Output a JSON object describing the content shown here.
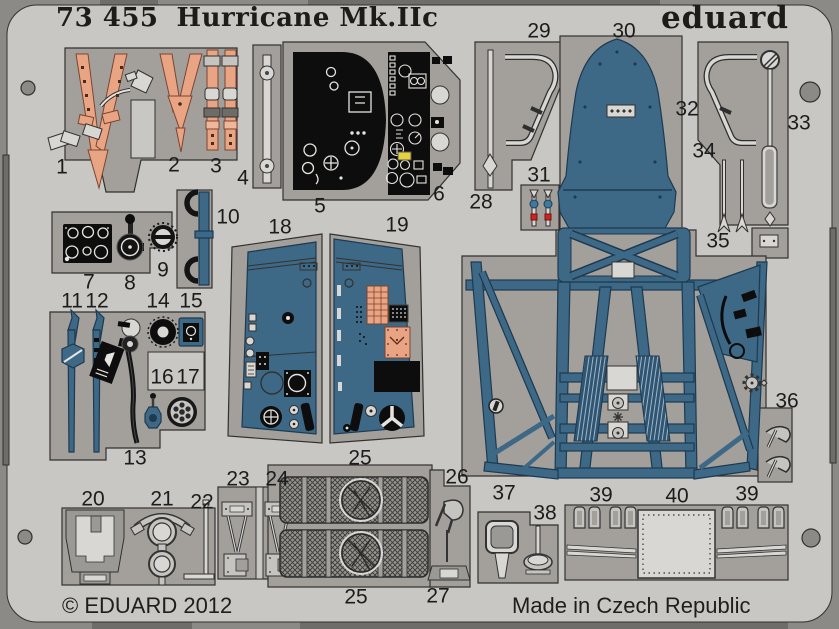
{
  "sheet": {
    "catalog_number": "73 455",
    "product_name": "Hurricane Mk.IIc",
    "brand": "eduard",
    "copyright": "© EDUARD 2012",
    "made_in": "Made in Czech Republic"
  },
  "colors": {
    "outer": "#8c8a86",
    "notch": "#6f6d69",
    "sheet": "#c9c7c3",
    "panel": "#a3a09c",
    "outline": "#33312e",
    "metal": "#c6c4c0",
    "metal_light": "#d9d7d3",
    "blue": "#3d6886",
    "blue_dark": "#1d3a50",
    "blue_tread": "#2f5573",
    "salmon": "#e9a484",
    "salmon_dark": "#7c4530",
    "black": "#0d0d0d",
    "red": "#c62820",
    "yellow": "#e3d23c",
    "white_detail": "#e6e4e0"
  },
  "part_labels": [
    {
      "n": "1",
      "x": 62,
      "y": 168
    },
    {
      "n": "2",
      "x": 174,
      "y": 166
    },
    {
      "n": "3",
      "x": 216,
      "y": 167
    },
    {
      "n": "4",
      "x": 243,
      "y": 179
    },
    {
      "n": "5",
      "x": 320,
      "y": 207
    },
    {
      "n": "6",
      "x": 439,
      "y": 195
    },
    {
      "n": "7",
      "x": 89,
      "y": 283
    },
    {
      "n": "8",
      "x": 130,
      "y": 284
    },
    {
      "n": "9",
      "x": 163,
      "y": 271
    },
    {
      "n": "10",
      "x": 228,
      "y": 218
    },
    {
      "n": "11",
      "x": 72,
      "y": 302
    },
    {
      "n": "12",
      "x": 97,
      "y": 302
    },
    {
      "n": "13",
      "x": 135,
      "y": 459
    },
    {
      "n": "14",
      "x": 158,
      "y": 302
    },
    {
      "n": "15",
      "x": 191,
      "y": 302
    },
    {
      "n": "16",
      "x": 162,
      "y": 378
    },
    {
      "n": "17",
      "x": 188,
      "y": 378
    },
    {
      "n": "18",
      "x": 280,
      "y": 228
    },
    {
      "n": "19",
      "x": 397,
      "y": 226
    },
    {
      "n": "20",
      "x": 93,
      "y": 500
    },
    {
      "n": "21",
      "x": 162,
      "y": 500
    },
    {
      "n": "22",
      "x": 202,
      "y": 503
    },
    {
      "n": "23",
      "x": 238,
      "y": 480
    },
    {
      "n": "24",
      "x": 277,
      "y": 480
    },
    {
      "n": "25",
      "x": 360,
      "y": 459
    },
    {
      "n": "25",
      "x": 356,
      "y": 598
    },
    {
      "n": "26",
      "x": 457,
      "y": 478
    },
    {
      "n": "27",
      "x": 438,
      "y": 597
    },
    {
      "n": "28",
      "x": 481,
      "y": 203
    },
    {
      "n": "29",
      "x": 539,
      "y": 32
    },
    {
      "n": "30",
      "x": 624,
      "y": 32
    },
    {
      "n": "31",
      "x": 539,
      "y": 176
    },
    {
      "n": "32",
      "x": 687,
      "y": 110
    },
    {
      "n": "33",
      "x": 799,
      "y": 124
    },
    {
      "n": "34",
      "x": 704,
      "y": 152
    },
    {
      "n": "35",
      "x": 718,
      "y": 242
    },
    {
      "n": "36",
      "x": 787,
      "y": 402
    },
    {
      "n": "37",
      "x": 504,
      "y": 494
    },
    {
      "n": "38",
      "x": 545,
      "y": 514
    },
    {
      "n": "39",
      "x": 601,
      "y": 496
    },
    {
      "n": "40",
      "x": 677,
      "y": 497
    },
    {
      "n": "39",
      "x": 747,
      "y": 495
    }
  ]
}
